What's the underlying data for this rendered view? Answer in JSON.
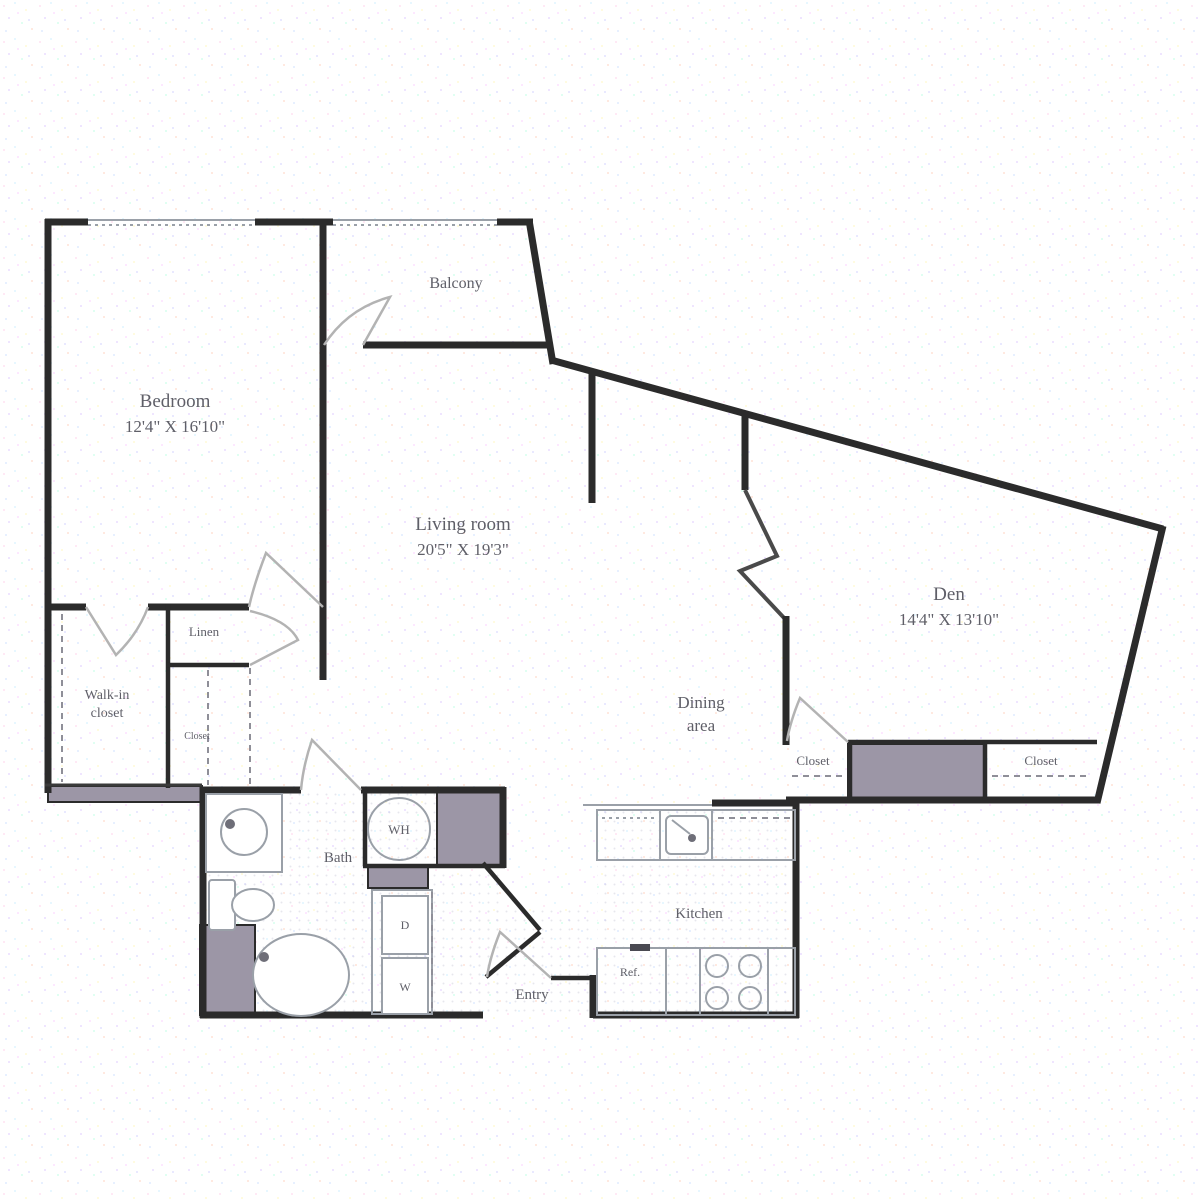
{
  "floorplan": {
    "colors": {
      "wall": "#2b2b2b",
      "label_text": "#5f5f68",
      "shaded_block": "#9c96a6",
      "fixture_line": "#9aa0a8",
      "door_arc": "#b3b3b3"
    },
    "rooms": {
      "balcony": {
        "label": "Balcony"
      },
      "bedroom": {
        "label": "Bedroom",
        "dims": "12'4\" X 16'10\""
      },
      "living_room": {
        "label": "Living room",
        "dims": "20'5\" X 19'3\""
      },
      "den": {
        "label": "Den",
        "dims": "14'4\" X 13'10\""
      },
      "dining_area": {
        "line1": "Dining",
        "line2": "area"
      },
      "kitchen": {
        "label": "Kitchen"
      },
      "bath": {
        "label": "Bath"
      },
      "entry": {
        "label": "Entry"
      },
      "walk_in_closet": {
        "line1": "Walk-in",
        "line2": "closet"
      },
      "linen_closet": {
        "label": "Linen"
      },
      "hall_closet": {
        "label": "Closet"
      },
      "den_closet_left": {
        "label": "Closet"
      },
      "den_closet_right": {
        "label": "Closet"
      }
    },
    "fixtures": {
      "water_heater_label": "WH",
      "dryer_label": "D",
      "washer_label": "W",
      "refrigerator_label": "Ref."
    }
  }
}
